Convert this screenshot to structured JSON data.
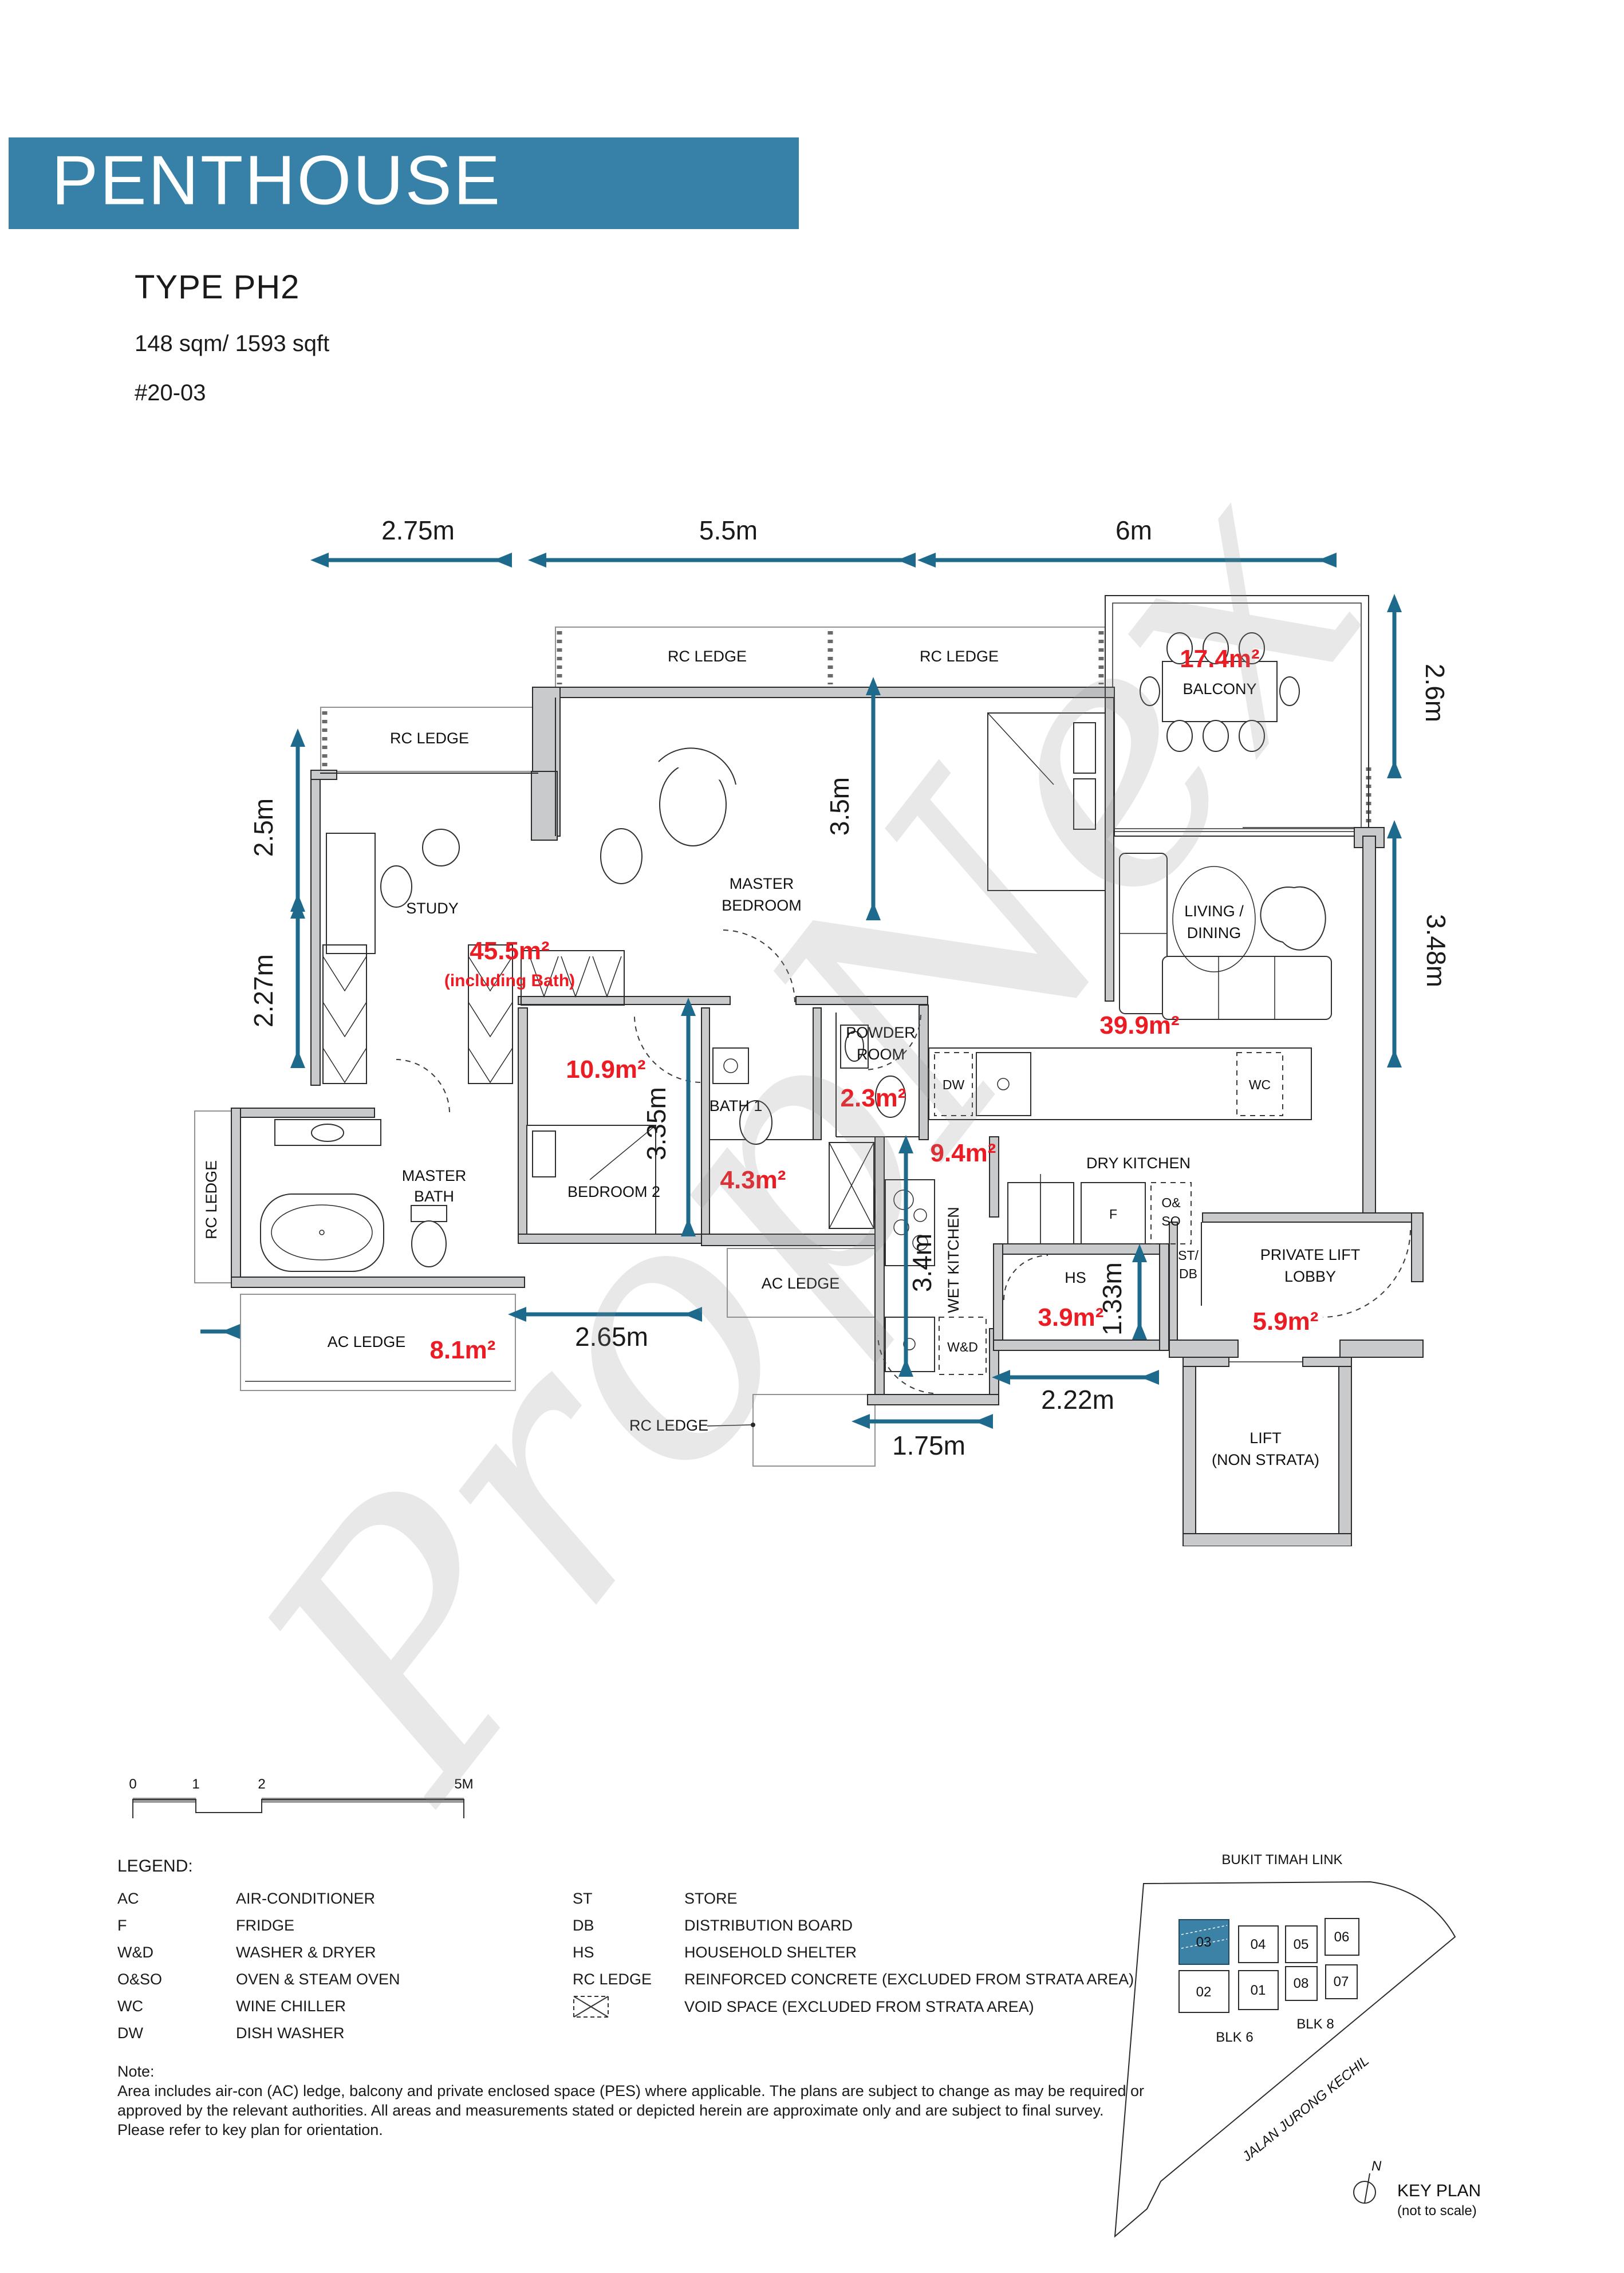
{
  "header": {
    "banner": "PENTHOUSE",
    "type_label": "TYPE PH2",
    "area_label": "148 sqm/ 1593 sqft",
    "unit_label": "#20-03",
    "banner_color": "#3780a8"
  },
  "plan": {
    "colors": {
      "dimension": "#1e6a8d",
      "area_text": "#ec1c24",
      "wall": "#c9cacc"
    },
    "dims": {
      "m275": "2.75m",
      "m55": "5.5m",
      "m6": "6m",
      "m26": "2.6m",
      "m348": "3.48m",
      "m25": "2.5m",
      "m227": "2.27m",
      "m35": "3.5m",
      "m335": "3.35m",
      "m34": "3.4m",
      "m265": "2.65m",
      "m133": "1.33m",
      "m222": "2.22m",
      "m175": "1.75m"
    },
    "areas": {
      "study": "45.5m²",
      "study_note": "(including Bath)",
      "balcony": "17.4m²",
      "living": "39.9m²",
      "bedroom2": "10.9m²",
      "powder": "2.3m²",
      "bath1": "4.3m²",
      "wet_kitchen": "9.4m²",
      "ac_ledge": "8.1m²",
      "hs": "3.9m²",
      "lift_lobby": "5.9m²"
    },
    "rooms": {
      "rc_ledge": "RC LEDGE",
      "rc_ledge_2": "RC LEDGE",
      "rc_ledge_3": "RC LEDGE",
      "rc_ledge_left": "RC LEDGE",
      "rc_ledge_bottom": "RC LEDGE",
      "ac_ledge": "AC LEDGE",
      "ac_ledge_2": "AC LEDGE",
      "study": "STUDY",
      "master_1": "MASTER",
      "master_2": "BEDROOM",
      "balcony": "BALCONY",
      "living_1": "LIVING /",
      "living_2": "DINING",
      "bedroom2": "BEDROOM 2",
      "master_bath_1": "MASTER",
      "master_bath_2": "BATH",
      "bath1": "BATH 1",
      "powder_1": "POWDER",
      "powder_2": "ROOM",
      "dry_kitchen": "DRY KITCHEN",
      "wet_kitchen": "WET KITCHEN",
      "hs": "HS",
      "st_db_1": "ST/",
      "st_db_2": "DB",
      "lobby_1": "PRIVATE LIFT",
      "lobby_2": "LOBBY",
      "lift_1": "LIFT",
      "lift_2": "(NON STRATA)",
      "dw": "DW",
      "wc": "WC",
      "f": "F",
      "oso_1": "O&",
      "oso_2": "SO",
      "wd": "W&D"
    }
  },
  "scalebar": {
    "t0": "0",
    "t1": "1",
    "t2": "2",
    "t5": "5M"
  },
  "legend": {
    "title": "LEGEND:",
    "left": [
      {
        "abbr": "AC",
        "desc": "AIR-CONDITIONER"
      },
      {
        "abbr": "F",
        "desc": "FRIDGE"
      },
      {
        "abbr": "W&D",
        "desc": "WASHER & DRYER"
      },
      {
        "abbr": "O&SO",
        "desc": "OVEN & STEAM OVEN"
      },
      {
        "abbr": "WC",
        "desc": "WINE CHILLER"
      },
      {
        "abbr": "DW",
        "desc": "DISH WASHER"
      }
    ],
    "right": [
      {
        "abbr": "ST",
        "desc": "STORE"
      },
      {
        "abbr": "DB",
        "desc": "DISTRIBUTION BOARD"
      },
      {
        "abbr": "HS",
        "desc": "HOUSEHOLD SHELTER"
      },
      {
        "abbr": "RC LEDGE",
        "desc": "REINFORCED CONCRETE  (EXCLUDED FROM STRATA AREA)"
      }
    ],
    "void_desc": "VOID SPACE (EXCLUDED FROM STRATA AREA)"
  },
  "note": {
    "title": "Note:",
    "line1": "Area includes air-con (AC) ledge, balcony and private  enclosed space (PES) where applicable.  The plans are  subject to change as may be required  or",
    "line2": "approved  by  the  relevant  authorities.  All  areas  and measurements stated  or  depicted  herein  are  approximate only  and  are  subject to  final  survey.",
    "line3": "Please refer to key plan for  orientation."
  },
  "keyplan": {
    "road_top": "BUKIT TIMAH LINK",
    "road_diag": "JALAN JURONG KECHIL",
    "blk6": "BLK 6",
    "blk8": "BLK 8",
    "units": [
      "03",
      "04",
      "05",
      "06",
      "02",
      "01",
      "08",
      "07"
    ],
    "north": "N",
    "title": "KEY PLAN",
    "subtitle": "(not to scale)",
    "highlight_color": "#3c82a6"
  },
  "watermark": "PropNex"
}
